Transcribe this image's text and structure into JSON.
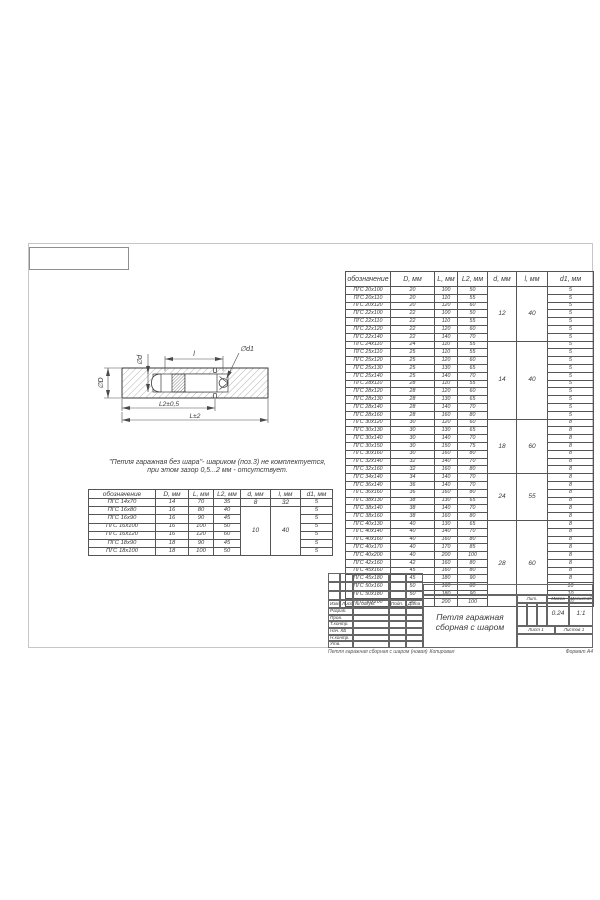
{
  "note": {
    "line1": "\"Петля гаражная без шара\"- шариком (поз.3) не комплектуется,",
    "line2": "при этом зазор 0,5...2 мм - отсутствует."
  },
  "drawing": {
    "labels": {
      "dia_D": "∅D",
      "dia_d": "∅d",
      "l": "l",
      "dia_d1": "∅d1",
      "L2": "L2±0,5",
      "L": "L±2"
    }
  },
  "main_table": {
    "headers": [
      "обозначение",
      "D, мм",
      "L, мм",
      "L2, мм",
      "d, мм",
      "l, мм",
      "d1, мм"
    ],
    "rows": [
      [
        "ПГС 20x100",
        "20",
        "100",
        "50",
        {
          "v": "12",
          "span": 7
        },
        {
          "v": "40",
          "span": 7
        },
        "5"
      ],
      [
        "ПГС 20x110",
        "20",
        "110",
        "55",
        "5"
      ],
      [
        "ПГС 20x120",
        "20",
        "120",
        "60",
        "5"
      ],
      [
        "ПГС 22x100",
        "22",
        "100",
        "50",
        "5"
      ],
      [
        "ПГС 22x110",
        "22",
        "110",
        "55",
        "5"
      ],
      [
        "ПГС 22x120",
        "22",
        "120",
        "60",
        "5"
      ],
      [
        "ПГС 22x140",
        "22",
        "140",
        "70",
        "5"
      ],
      [
        "ПГС 24x110",
        "24",
        "110",
        "55",
        {
          "v": "14",
          "span": 10
        },
        {
          "v": "40",
          "span": 10
        },
        "5"
      ],
      [
        "ПГС 25x110",
        "25",
        "110",
        "55",
        "5"
      ],
      [
        "ПГС 25x120",
        "25",
        "120",
        "60",
        "5"
      ],
      [
        "ПГС 25x130",
        "25",
        "130",
        "65",
        "5"
      ],
      [
        "ПГС 25x140",
        "25",
        "140",
        "70",
        "5"
      ],
      [
        "ПГС 28x110",
        "28",
        "110",
        "55",
        "5"
      ],
      [
        "ПГС 28x120",
        "28",
        "120",
        "60",
        "5"
      ],
      [
        "ПГС 28x130",
        "28",
        "130",
        "65",
        "5"
      ],
      [
        "ПГС 28x140",
        "28",
        "140",
        "70",
        "5"
      ],
      [
        "ПГС 28x160",
        "28",
        "160",
        "80",
        "5"
      ],
      [
        "ПГС 30x120",
        "30",
        "120",
        "60",
        {
          "v": "18",
          "span": 7
        },
        {
          "v": "60",
          "span": 7
        },
        "8"
      ],
      [
        "ПГС 30x130",
        "30",
        "130",
        "65",
        "8"
      ],
      [
        "ПГС 30x140",
        "30",
        "140",
        "70",
        "8"
      ],
      [
        "ПГС 30x150",
        "30",
        "150",
        "75",
        "8"
      ],
      [
        "ПГС 30x160",
        "30",
        "160",
        "80",
        "8"
      ],
      [
        "ПГС 32x140",
        "32",
        "140",
        "70",
        "8"
      ],
      [
        "ПГС 32x160",
        "32",
        "160",
        "80",
        "8"
      ],
      [
        "ПГС 34x140",
        "34",
        "140",
        "70",
        {
          "v": "24",
          "span": 6
        },
        {
          "v": "55",
          "span": 6
        },
        "8"
      ],
      [
        "ПГС 36x140",
        "36",
        "140",
        "70",
        "8"
      ],
      [
        "ПГС 36x160",
        "36",
        "160",
        "80",
        "8"
      ],
      [
        "ПГС 38x130",
        "38",
        "130",
        "65",
        "8"
      ],
      [
        "ПГС 38x140",
        "38",
        "140",
        "70",
        "8"
      ],
      [
        "ПГС 38x160",
        "38",
        "160",
        "80",
        "8"
      ],
      [
        "ПГС 40x130",
        "40",
        "130",
        "65",
        {
          "v": "28",
          "span": 11
        },
        {
          "v": "60",
          "span": 11
        },
        "8"
      ],
      [
        "ПГС 40x140",
        "40",
        "140",
        "70",
        "8"
      ],
      [
        "ПГС 40x160",
        "40",
        "160",
        "80",
        "8"
      ],
      [
        "ПГС 40x170",
        "40",
        "170",
        "85",
        "8"
      ],
      [
        "ПГС 40x200",
        "40",
        "200",
        "100",
        "8"
      ],
      [
        "ПГС 42x160",
        "42",
        "160",
        "80",
        "8"
      ],
      [
        "ПГС 45x160",
        "45",
        "160",
        "80",
        "8"
      ],
      [
        "ПГС 45x180",
        "45",
        "180",
        "90",
        "8"
      ],
      [
        "ПГС 50x160",
        "50",
        "160",
        "80",
        "10"
      ],
      [
        "ПГС 50x180",
        "50",
        "180",
        "90",
        "10"
      ],
      [
        "ПГС 50x200",
        "50",
        "200",
        "100",
        "10"
      ]
    ]
  },
  "small_table": {
    "headers": [
      "обозначение",
      "D, мм",
      "L, мм",
      "L2, мм",
      "d, мм",
      "l, мм",
      "d1, мм"
    ],
    "rows": [
      [
        "ПГС 14x70",
        "14",
        "70",
        "35",
        {
          "v": "8",
          "span": 1
        },
        {
          "v": "32",
          "span": 1
        },
        "5"
      ],
      [
        "ПГС 16x80",
        "16",
        "80",
        "40",
        {
          "v": "10",
          "span": 6
        },
        {
          "v": "40",
          "span": 6
        },
        "5"
      ],
      [
        "ПГС 16x90",
        "16",
        "90",
        "45",
        "5"
      ],
      [
        "ПГС 16x100",
        "16",
        "100",
        "50",
        "5"
      ],
      [
        "ПГС 16x120",
        "16",
        "120",
        "60",
        "5"
      ],
      [
        "ПГС 18x90",
        "18",
        "90",
        "45",
        "5"
      ],
      [
        "ПГС 18x100",
        "18",
        "100",
        "50",
        "5"
      ]
    ]
  },
  "title_block": {
    "title_line1": "Петля гаражная",
    "title_line2": "сборная с шаром",
    "rev_headers": [
      "Изм.",
      "Лист",
      "№ докум.",
      "Подп.",
      "Дата"
    ],
    "roles": [
      "Разраб.",
      "Пров.",
      "Т.контр.",
      "Нач. КБ",
      "Н.контр.",
      "Утв."
    ],
    "lit_label": "Лит.",
    "mass_label": "Масса",
    "scale_label": "Масштаб",
    "mass_value": "0.24",
    "scale_value": "1:1",
    "sheet_label": "Лист 1",
    "sheets_label": "Листов 1"
  },
  "footer": {
    "doc_name": "Петля гаражная сборная с шаром (новая)",
    "copied_label": "Копировал",
    "format_label": "Формат А4"
  }
}
